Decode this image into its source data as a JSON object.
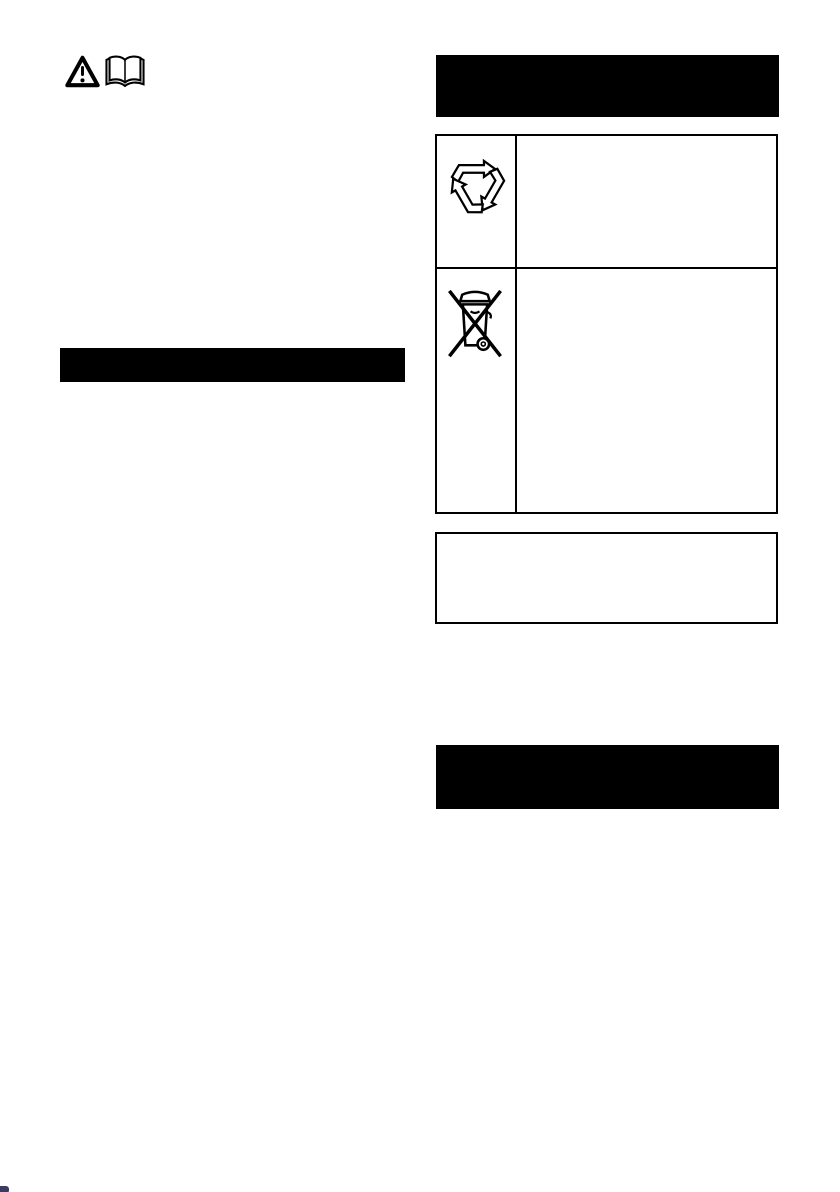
{
  "page": {
    "background_color": "#ffffff",
    "ink_color": "#000000"
  },
  "header_icons": {
    "warning_icon": "warning-triangle-exclamation",
    "manual_icon": "open-book"
  },
  "left_column": {
    "section_bar": {
      "label": "",
      "background": "#000000"
    }
  },
  "right_column": {
    "top_section_bar": {
      "label": "",
      "background": "#000000"
    },
    "symbol_table": {
      "rows": [
        {
          "icon": "recycling-arrows-symbol",
          "text": ""
        },
        {
          "icon": "weee-crossed-out-wheelie-bin-symbol",
          "text": ""
        }
      ]
    },
    "note_box": {
      "text": ""
    },
    "bottom_section_bar": {
      "label": "",
      "background": "#000000"
    }
  },
  "artifacts": {
    "bottom_left_corner_mark": {
      "color": "#191946"
    }
  }
}
